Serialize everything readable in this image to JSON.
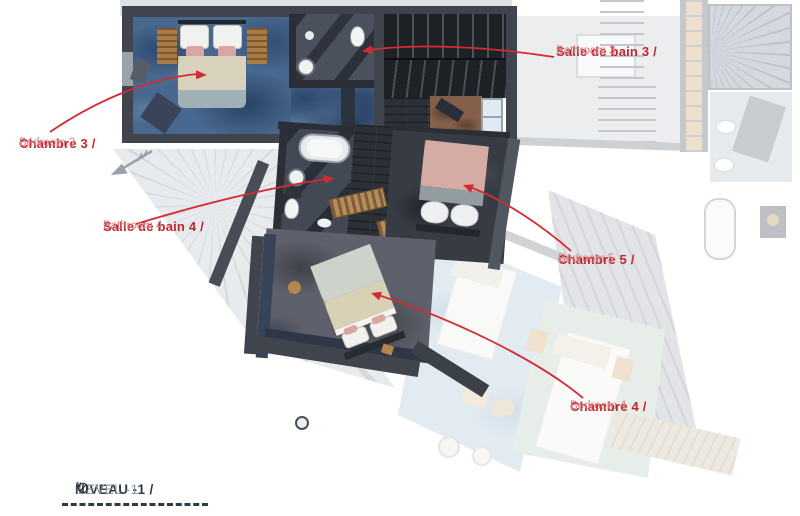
{
  "annotations": {
    "chambre3": {
      "fr": "Chambre 3 /",
      "en": "Bedroom 3"
    },
    "bathroom3": {
      "fr": "Salle de bain 3 /",
      "en": "Bathroom 3"
    },
    "bathroom4": {
      "fr": "Salle de bain 4 /",
      "en": "Bathroom 4"
    },
    "chambre5": {
      "fr": "Chambre 5 /",
      "en": "Bedroom 5"
    },
    "chambre4": {
      "fr": "Chambre 4 /",
      "en": "Bedroom 4"
    }
  },
  "footer": {
    "level_fr": "NIVEAU -1 /",
    "level_en": "LEVEL -1",
    "north_letter": "N"
  },
  "icons": {
    "north_indicator": "north-indicator-icon",
    "direction_vane": "direction-vane-icon",
    "column_marker": "column-marker-icon"
  },
  "colors": {
    "label_red_bold": "#c4262e",
    "label_red_light": "#d47d7f",
    "leader_red": "#d22b33",
    "title_dark": "#2e3b45",
    "title_light": "#8a949c",
    "carpet_blue": "#49688f",
    "carpet_gray": "#5e616b",
    "wall_dark": "#40454d",
    "stair_dark": "#1e2125",
    "roof_gray": "#dfe3e7"
  }
}
